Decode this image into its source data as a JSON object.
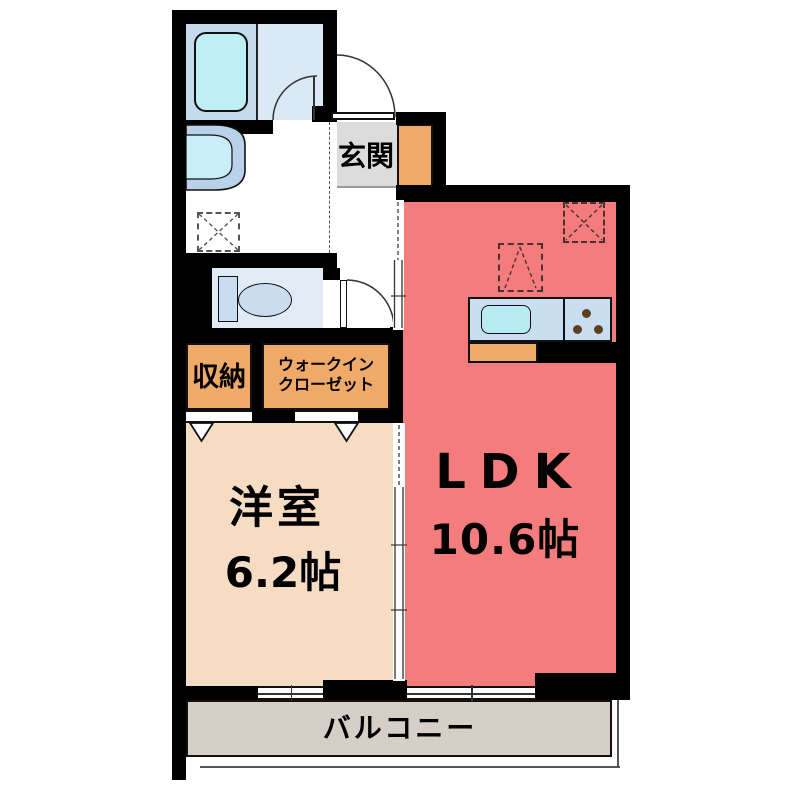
{
  "rooms": {
    "genkan": {
      "label": "玄関"
    },
    "ldk": {
      "label": "LDK",
      "area": "10.6帖"
    },
    "western_room": {
      "label": "洋室",
      "area": "6.2帖"
    },
    "storage": {
      "label": "収納"
    },
    "walk_in_closet": {
      "line1": "ウォークイン",
      "line2": "クローゼット"
    },
    "balcony": {
      "label": "バルコニー"
    }
  },
  "fixtures": {
    "bathtub": "bathtub",
    "washbasin": "washbasin",
    "washing_machine_space": "washing-machine-space",
    "toilet": "toilet",
    "kitchen_sink": "kitchen-sink",
    "stove": "stove-burners",
    "refrigerator_space": "refrigerator-space",
    "appliance_space": "appliance-space",
    "shoe_cabinet": "shoe-cabinet"
  },
  "palette": {
    "wall": "#000000",
    "ldk_floor": "#f47c7c",
    "western_room_floor": "#f5dcc3",
    "closet_orange": "#efa968",
    "genkan_gray": "#dcdcdc",
    "balcony_gray": "#d5cfc7",
    "bath_floor": "#dbe8f6",
    "bath_surround": "#c6daee",
    "bathtub_fill": "#beeef6",
    "toilet_room": "#e0ebf5",
    "counter_blue": "#cadef2",
    "sink_cyan": "#b8ecf4",
    "burner_brown": "#5d3f23"
  }
}
